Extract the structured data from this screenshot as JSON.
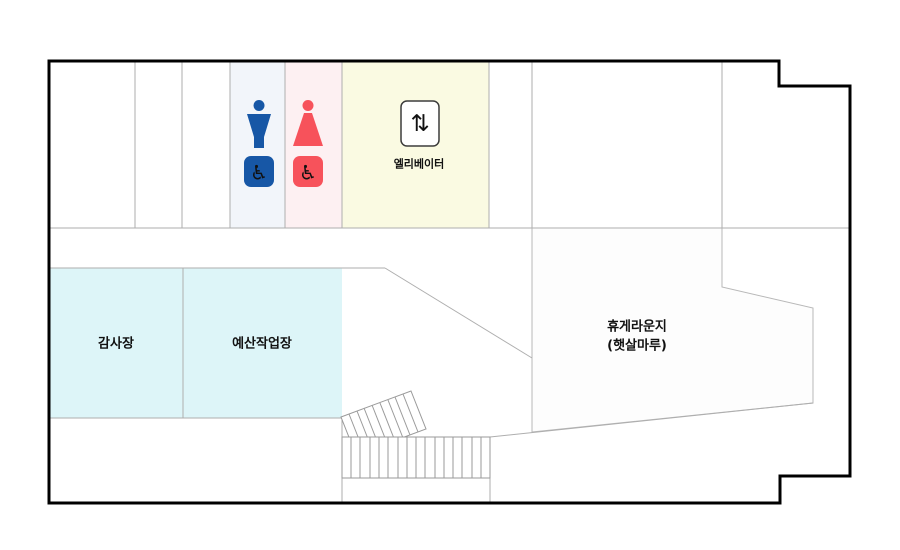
{
  "floor_plan": {
    "rooms": {
      "audit_room": {
        "label": "감사장"
      },
      "budget_workroom": {
        "label": "예산작업장"
      },
      "lounge": {
        "label_line1": "휴게라운지",
        "label_line2": "(햇살마루)"
      },
      "elevator": {
        "label": "엘리베이터",
        "arrows_glyph": "⇅"
      }
    },
    "restrooms": {
      "wheelchair_glyph": "♿"
    },
    "colors": {
      "wall": "#000000",
      "interior_line": "#aeaeae",
      "stairs_line": "#9a9a9a",
      "mens_zone_bg": "#f2f5fa",
      "womens_zone_bg": "#fdf0f2",
      "elevator_zone_bg": "#fafae2",
      "meeting_room_bg": "#ddf5f8",
      "lounge_bg": "#fdfdfd",
      "lounge_border": "#b8b8b8",
      "male_icon": "#1757a6",
      "female_icon": "#f7525b",
      "icon_glyph": "#ffffff",
      "elevator_box_border": "#3c3c3c",
      "text": "#111111"
    }
  }
}
